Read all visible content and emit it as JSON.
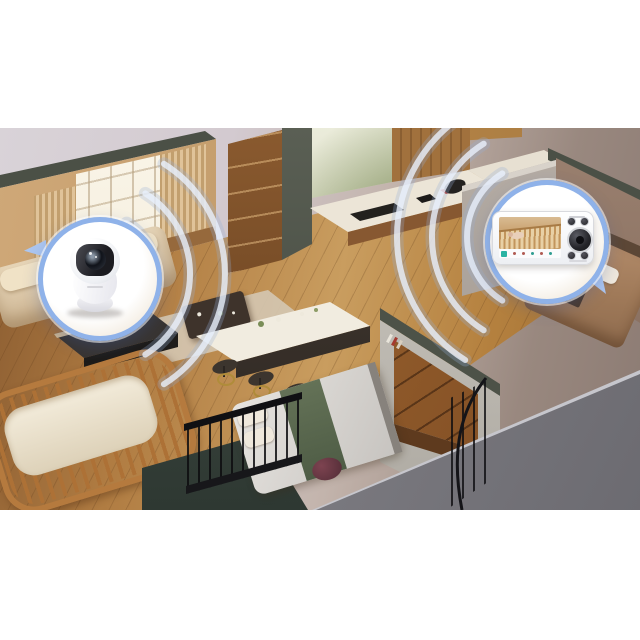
{
  "image": {
    "kind": "product-marketing-render",
    "description": "Isometric cutaway of a home; a white pan-tilt baby camera in the nursery streams over wireless signal waves to a handheld video baby monitor in the master bedroom",
    "background_color": "#ffffff",
    "photo_backdrop_colors": [
      "#d9d3d8",
      "#8b7a72"
    ]
  },
  "rooms": [
    {
      "label": "living-room",
      "items": [
        "tall-windows",
        "curtains",
        "beige-sofa",
        "coffee-table",
        "rug"
      ]
    },
    {
      "label": "kitchen",
      "items": [
        "wood-shelves",
        "window-with-greenery",
        "white-counter",
        "cooktop",
        "red-appliance"
      ]
    },
    {
      "label": "dining",
      "items": [
        "white-island",
        "bar-stools"
      ]
    },
    {
      "label": "nursery",
      "items": [
        "wooden-crib",
        "white-mattress",
        "camera-stand"
      ]
    },
    {
      "label": "guest-bedroom",
      "items": [
        "gray-duvet-bed",
        "green-runner",
        "maroon-pouf",
        "stair-railing"
      ]
    },
    {
      "label": "master-bedroom",
      "items": [
        "tan-duvet-bed",
        "white-pillows",
        "nightstand",
        "brass-lamp",
        "walnut-drawer-wall",
        "spiral-stair-railing"
      ]
    }
  ],
  "devices": {
    "camera": {
      "label": "baby-camera",
      "body_color": "#ffffff",
      "lens_color": "#10131a",
      "badge_ring_color": "#8fb2e9"
    },
    "monitor": {
      "label": "video-baby-monitor",
      "body_color": "#ffffff",
      "screen_scene": "baby-sleeping-in-wooden-crib",
      "badge_ring_color": "#8fb2e9",
      "icon_bar": [
        {
          "name": "active-menu-icon",
          "color": "#2ab3a3"
        },
        {
          "name": "icon-2",
          "color": "#b05a52"
        },
        {
          "name": "icon-3",
          "color": "#b05a52"
        },
        {
          "name": "icon-4",
          "color": "#2f9d91"
        },
        {
          "name": "icon-5",
          "color": "#b05a52"
        },
        {
          "name": "icon-6",
          "color": "#2f9d91"
        }
      ],
      "controls": [
        "button-top-1",
        "button-top-2",
        "dial",
        "button-bottom-1",
        "button-bottom-2"
      ]
    }
  },
  "signal_waves": {
    "left_arc_count": 3,
    "right_arc_count": 3,
    "color": "rgba(228,237,250,0.75)"
  }
}
